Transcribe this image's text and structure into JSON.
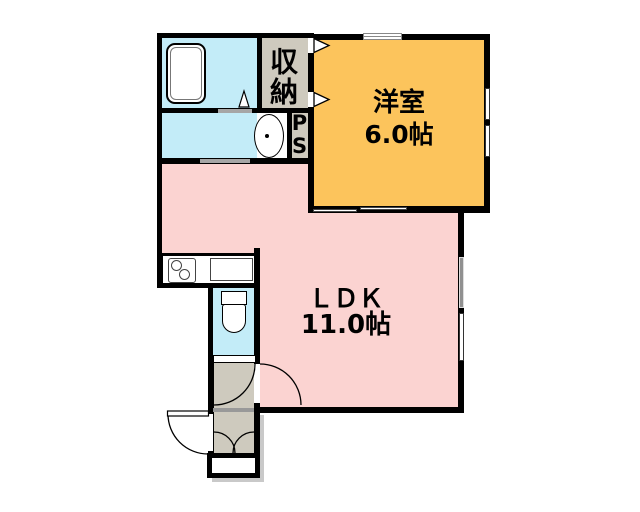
{
  "floorplan": {
    "rooms": {
      "western": {
        "name": "洋室",
        "size": "6.0帖"
      },
      "ldk": {
        "name": "ＬＤＫ",
        "size": "11.0帖"
      },
      "storage": {
        "name": "収納"
      },
      "pipe_space": {
        "p": "P",
        "s": "S"
      }
    },
    "colors": {
      "western_room": "#fcc45c",
      "ldk_room": "#fbd3d1",
      "water_rooms": "#c3ecf8",
      "hall_storage": "#cecabe",
      "walls": "#000000",
      "door_opening_bar": "#a6a6a6",
      "shaded_window": "#909090",
      "shadow": "#c9c9c9"
    }
  }
}
